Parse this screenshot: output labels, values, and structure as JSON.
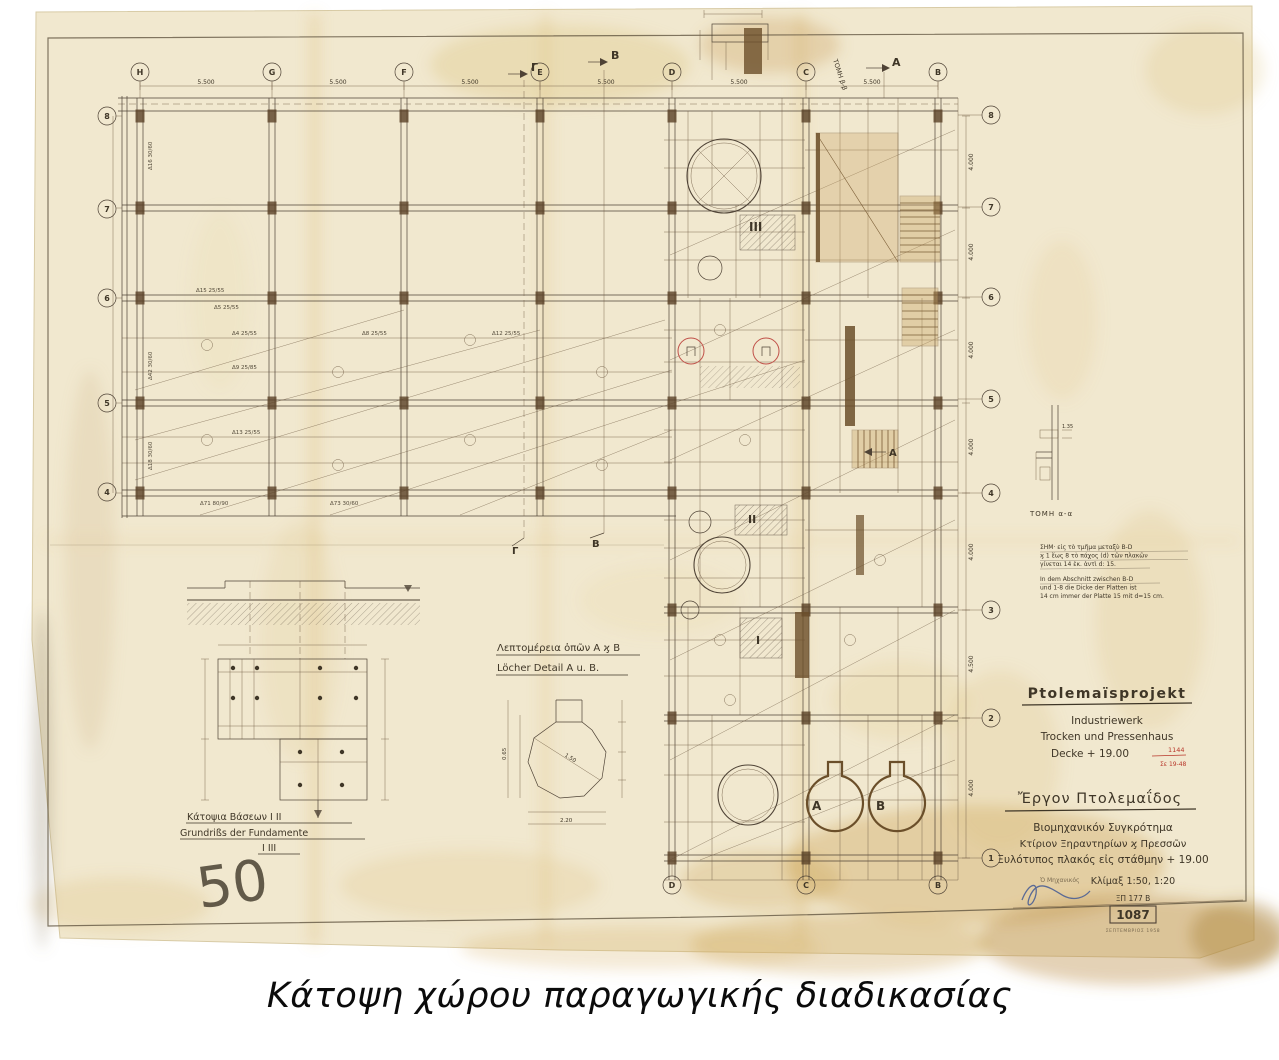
{
  "caption": "Κάτοψη χώρου παραγωγικής διαδικασίας",
  "title_block": {
    "project": "Ptolemaïsprojekt",
    "sub1": "Industriewerk",
    "sub2": "Trocken und Pressenhaus",
    "sub3": "Decke + 19.00",
    "stamp1": "1144",
    "stamp2": "Σε 19-48",
    "greek_title": "Ἔργον Πτολεμαΐδος",
    "greek1": "Βιομηχανικόν Συγκρότημα",
    "greek2": "Κτίριον Ξηραντηρίων ϗ Πρεσσῶν",
    "greek3": "Ξυλότυπος πλακός εἰς στάθμην + 19.00",
    "engineer": "Ὁ Μηχανικός",
    "scale": "Κλίμαξ 1:50, 1:20",
    "code": "ΞΠ 177 Β",
    "number": "1087",
    "date": "ΣΕΠΤΕΜΒΡΙΟΣ 1958"
  },
  "notes": {
    "gr1": "ΣΗΜ· εἰς τὸ τμῆμα μεταξὺ B-D",
    "gr2": "ϗ 1 ἕως 8 τὸ πάχος (d) τῶν πλακῶν",
    "gr3": "γίνεται 14 ἑκ. ἀντὶ d: 15.",
    "de1": "In dem Abschnitt zwischen B-D",
    "de2": "und 1-8 die Dicke der Platten ist",
    "de3": "14 cm immer der Platte 15 mit d=15 cm."
  },
  "labels": {
    "foundation_gr": "Κάτοψια Βάσεων Ι ΙΙ",
    "foundation_de": "Grundrißs der Fundamente",
    "foundation_de2": "Ι ΙΙΙ",
    "holes_gr": "Λεπτομέρεια ὀπῶν Α ϗ Β",
    "holes_de": "Löcher Detail A u. B.",
    "section_aa": "ΤΟΜΗ α-α",
    "section_bb": "ΤΟΜΗ β-β",
    "pencil": "50",
    "hole_a": "A",
    "hole_b": "B",
    "zone1": "I",
    "zone2": "II",
    "zone3": "III",
    "marker_top_gamma": "Γ",
    "marker_top_b": "B",
    "marker_top_a": "A",
    "marker_bottom_gamma": "Γ",
    "marker_bottom_b": "B",
    "marker_mid_a": "A"
  },
  "grid": {
    "top_letters": [
      "H",
      "G",
      "F",
      "E",
      "D",
      "C",
      "B"
    ],
    "bottom_letters": [
      "D",
      "C",
      "B"
    ],
    "left_numbers": [
      "8",
      "7",
      "6",
      "5",
      "4"
    ],
    "right_numbers": [
      "8",
      "7",
      "6",
      "5",
      "4",
      "3",
      "2",
      "1"
    ]
  },
  "dims": [
    "5.500",
    "5.500",
    "5.500",
    "5.500",
    "5.500",
    "5.500",
    "4.000",
    "4.000",
    "4.000",
    "4.000",
    "4.000",
    "4.500",
    "4.000"
  ],
  "beam_labels": [
    "Δ16 30/60",
    "Δ15 25/55",
    "Δ5 25/55",
    "Δ4 25/55",
    "Δ8 25/55",
    "Δ12 25/55",
    "Δ9 25/85",
    "Δ13 25/55",
    "Δ42 30/60",
    "Δ18 30/60",
    "Δ71 80/90",
    "Δ73 30/60"
  ],
  "detail_dims": [
    "2.20",
    "1.50",
    "1.35",
    "0.65"
  ],
  "colors": {
    "paper": "#f1e8cf",
    "ink": "#4f4336",
    "sepia": "#6b4f2a",
    "stain": "#d6ae57",
    "red_stamp": "#b8372b",
    "pencil": "#98948c",
    "signature": "#5a6a95"
  }
}
